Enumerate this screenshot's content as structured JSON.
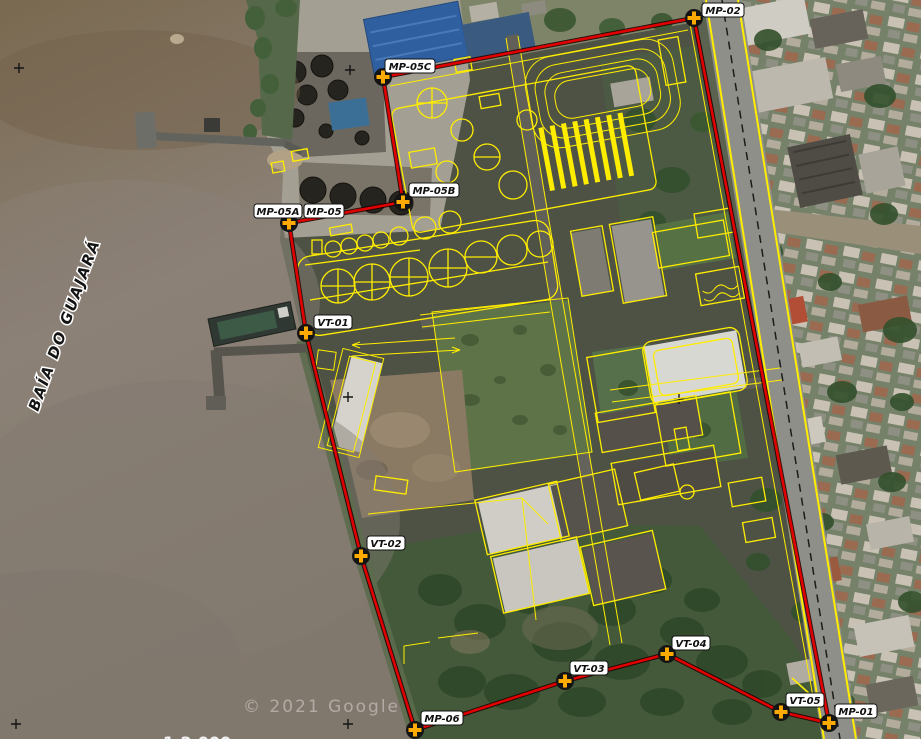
{
  "map": {
    "water_label": "BAÍA DO GUAJARÁ",
    "watermark": "© 2021 Google",
    "scale_label": "1:2.000",
    "colors": {
      "boundary_red": "#e00000",
      "cad_yellow": "#ffed00",
      "marker_cross_orange": "#ffaa00",
      "marker_disc_black": "#141414",
      "water_brown": "#85796b"
    },
    "icons": {
      "survey_marker": "circle-with-orange-cross",
      "grid_mark": "plus-cross"
    }
  },
  "markers": [
    {
      "id": "mp-02",
      "label": "MP-02"
    },
    {
      "id": "mp-05c",
      "label": "MP-05C"
    },
    {
      "id": "mp-05b",
      "label": "MP-05B"
    },
    {
      "id": "mp-05a",
      "label": "MP-05A"
    },
    {
      "id": "mp-05",
      "label": "MP-05"
    },
    {
      "id": "vt-01",
      "label": "VT-01"
    },
    {
      "id": "vt-02",
      "label": "VT-02"
    },
    {
      "id": "mp-06",
      "label": "MP-06"
    },
    {
      "id": "vt-03",
      "label": "VT-03"
    },
    {
      "id": "vt-04",
      "label": "VT-04"
    },
    {
      "id": "vt-05",
      "label": "VT-05"
    },
    {
      "id": "mp-01",
      "label": "MP-01"
    }
  ]
}
